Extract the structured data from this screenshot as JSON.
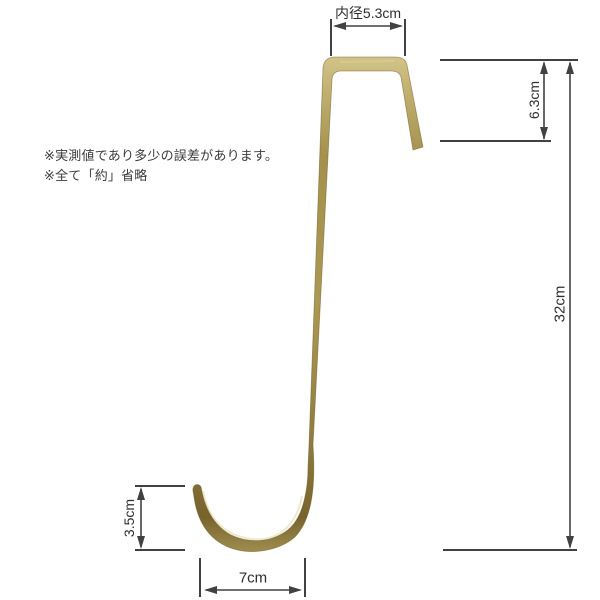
{
  "diagram": {
    "notes": {
      "line1": "※実測値であり多少の誤差があります。",
      "line2": "※全て「約」省略"
    },
    "dimensions": {
      "inner_width": {
        "label": "内径5.3cm",
        "value_cm": 5.3
      },
      "top_depth": {
        "label": "6.3cm",
        "value_cm": 6.3
      },
      "total_height": {
        "label": "32cm",
        "value_cm": 32
      },
      "hook_opening_height": {
        "label": "3.5cm",
        "value_cm": 3.5
      },
      "hook_width": {
        "label": "7cm",
        "value_cm": 7
      }
    },
    "colors": {
      "background": "#ffffff",
      "dimension_lines": "#414141",
      "label_text": "#2e2e2e",
      "brass_light": "#d2c488",
      "brass_mid": "#a4914c",
      "brass_dark": "#77632c"
    }
  }
}
